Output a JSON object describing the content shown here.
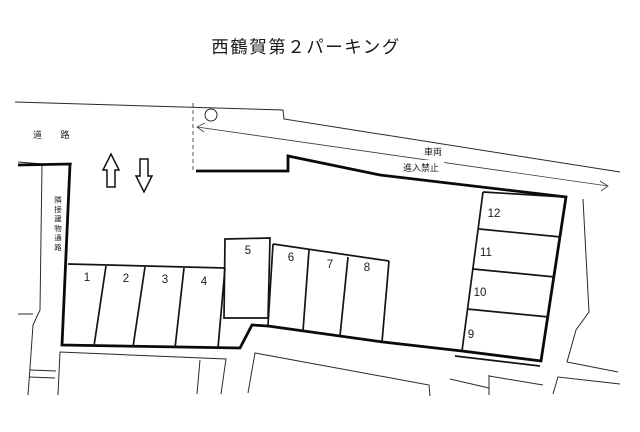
{
  "title": "西鶴賀第２パーキング",
  "road": {
    "label": "道 路"
  },
  "no_entry": {
    "line1": "車両",
    "line2": "進入禁止"
  },
  "passage": {
    "label": "隣接建物通路"
  },
  "stalls": [
    "1",
    "2",
    "3",
    "4",
    "5",
    "6",
    "7",
    "8",
    "9",
    "10",
    "11",
    "12"
  ],
  "colors": {
    "line": "#1a1a1a",
    "background": "#ffffff"
  }
}
